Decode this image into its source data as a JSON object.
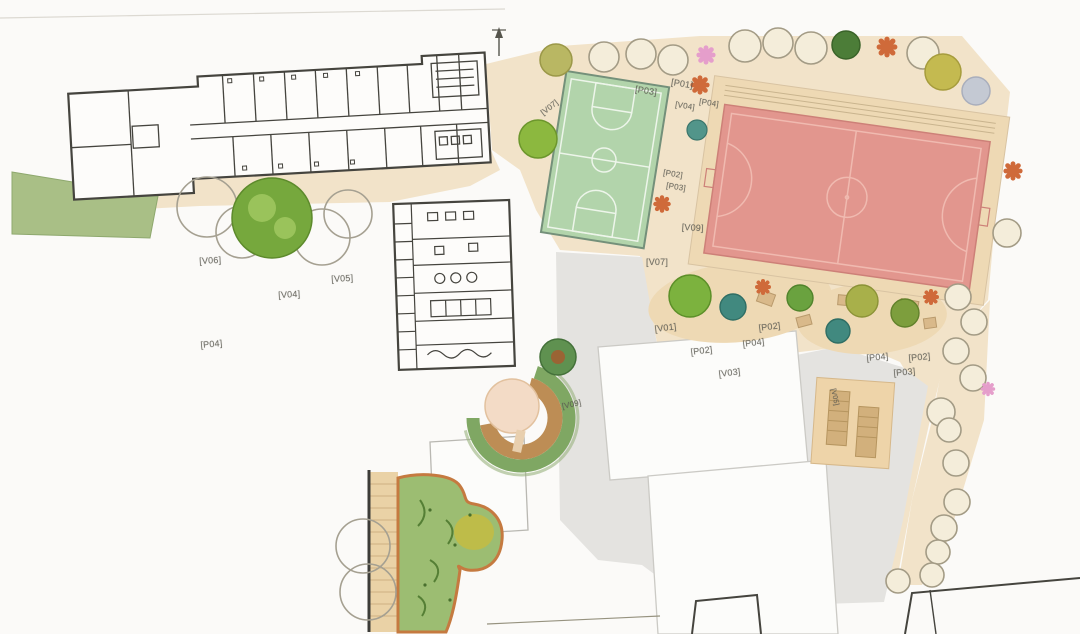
{
  "plan": {
    "colors": {
      "paper": "#fbfaf8",
      "wall_dark": "#45443e",
      "beige": "#f2e3c9",
      "beige2": "#eed9b4",
      "gray_plaza": "#e4e3e0",
      "court_green": "#b2d4ab",
      "court_lines": "#edf5ea",
      "field_red": "#e2968e",
      "field_lines": "#f0bab0",
      "field_border": "#cd8078",
      "grass_green": "#a9bf86",
      "garden_green": "#9cbd72",
      "garden_border": "#c57a40",
      "boardwalk": "#ead2a6",
      "tan_deck": "#eed4a9",
      "tree_green": "#76a83d",
      "tree_pale": "#f4edda",
      "tree_teal": "#41897f",
      "flower_orange": "#cf6a3a",
      "flower_pink": "#e59ecb",
      "ring_green": "#7fa763",
      "ring_brown": "#bd8d55"
    },
    "icons": {
      "north_arrow": "north-arrow-icon"
    },
    "labels": [
      {
        "text": "[V06]",
        "x": 199,
        "y": 256,
        "rot": -3,
        "size": 9
      },
      {
        "text": "[V04]",
        "x": 278,
        "y": 290,
        "rot": -3,
        "size": 9
      },
      {
        "text": "[V05]",
        "x": 331,
        "y": 274,
        "rot": -3,
        "size": 9
      },
      {
        "text": "[P04]",
        "x": 200,
        "y": 340,
        "rot": -5,
        "size": 9
      },
      {
        "text": "[V07]",
        "x": 539,
        "y": 110,
        "rot": -38,
        "size": 8
      },
      {
        "text": "[P03]",
        "x": 636,
        "y": 84,
        "rot": 9,
        "size": 9
      },
      {
        "text": "[P01]",
        "x": 672,
        "y": 77,
        "rot": 9,
        "size": 9
      },
      {
        "text": "[V04]",
        "x": 676,
        "y": 100,
        "rot": 9,
        "size": 8
      },
      {
        "text": "[P04]",
        "x": 700,
        "y": 97,
        "rot": 9,
        "size": 8
      },
      {
        "text": "[P02]",
        "x": 664,
        "y": 168,
        "rot": 9,
        "size": 8
      },
      {
        "text": "[P03]",
        "x": 667,
        "y": 181,
        "rot": 9,
        "size": 8
      },
      {
        "text": "[V09]",
        "x": 682,
        "y": 222,
        "rot": 3,
        "size": 9
      },
      {
        "text": "[V07]",
        "x": 646,
        "y": 257,
        "rot": 0,
        "size": 9
      },
      {
        "text": "[V01]",
        "x": 654,
        "y": 324,
        "rot": -7,
        "size": 9
      },
      {
        "text": "[P02]",
        "x": 758,
        "y": 323,
        "rot": -7,
        "size": 9
      },
      {
        "text": "[P04]",
        "x": 742,
        "y": 339,
        "rot": -7,
        "size": 9
      },
      {
        "text": "[P02]",
        "x": 690,
        "y": 347,
        "rot": -7,
        "size": 9
      },
      {
        "text": "[V03]",
        "x": 718,
        "y": 369,
        "rot": -7,
        "size": 9
      },
      {
        "text": "[P04]",
        "x": 866,
        "y": 353,
        "rot": -5,
        "size": 9
      },
      {
        "text": "[P02]",
        "x": 908,
        "y": 353,
        "rot": -5,
        "size": 9
      },
      {
        "text": "[P03]",
        "x": 893,
        "y": 368,
        "rot": -5,
        "size": 9
      },
      {
        "text": "[V05]",
        "x": 836,
        "y": 388,
        "rot": 78,
        "size": 7
      },
      {
        "text": "[V09]",
        "x": 561,
        "y": 402,
        "rot": -12,
        "size": 8
      }
    ]
  }
}
